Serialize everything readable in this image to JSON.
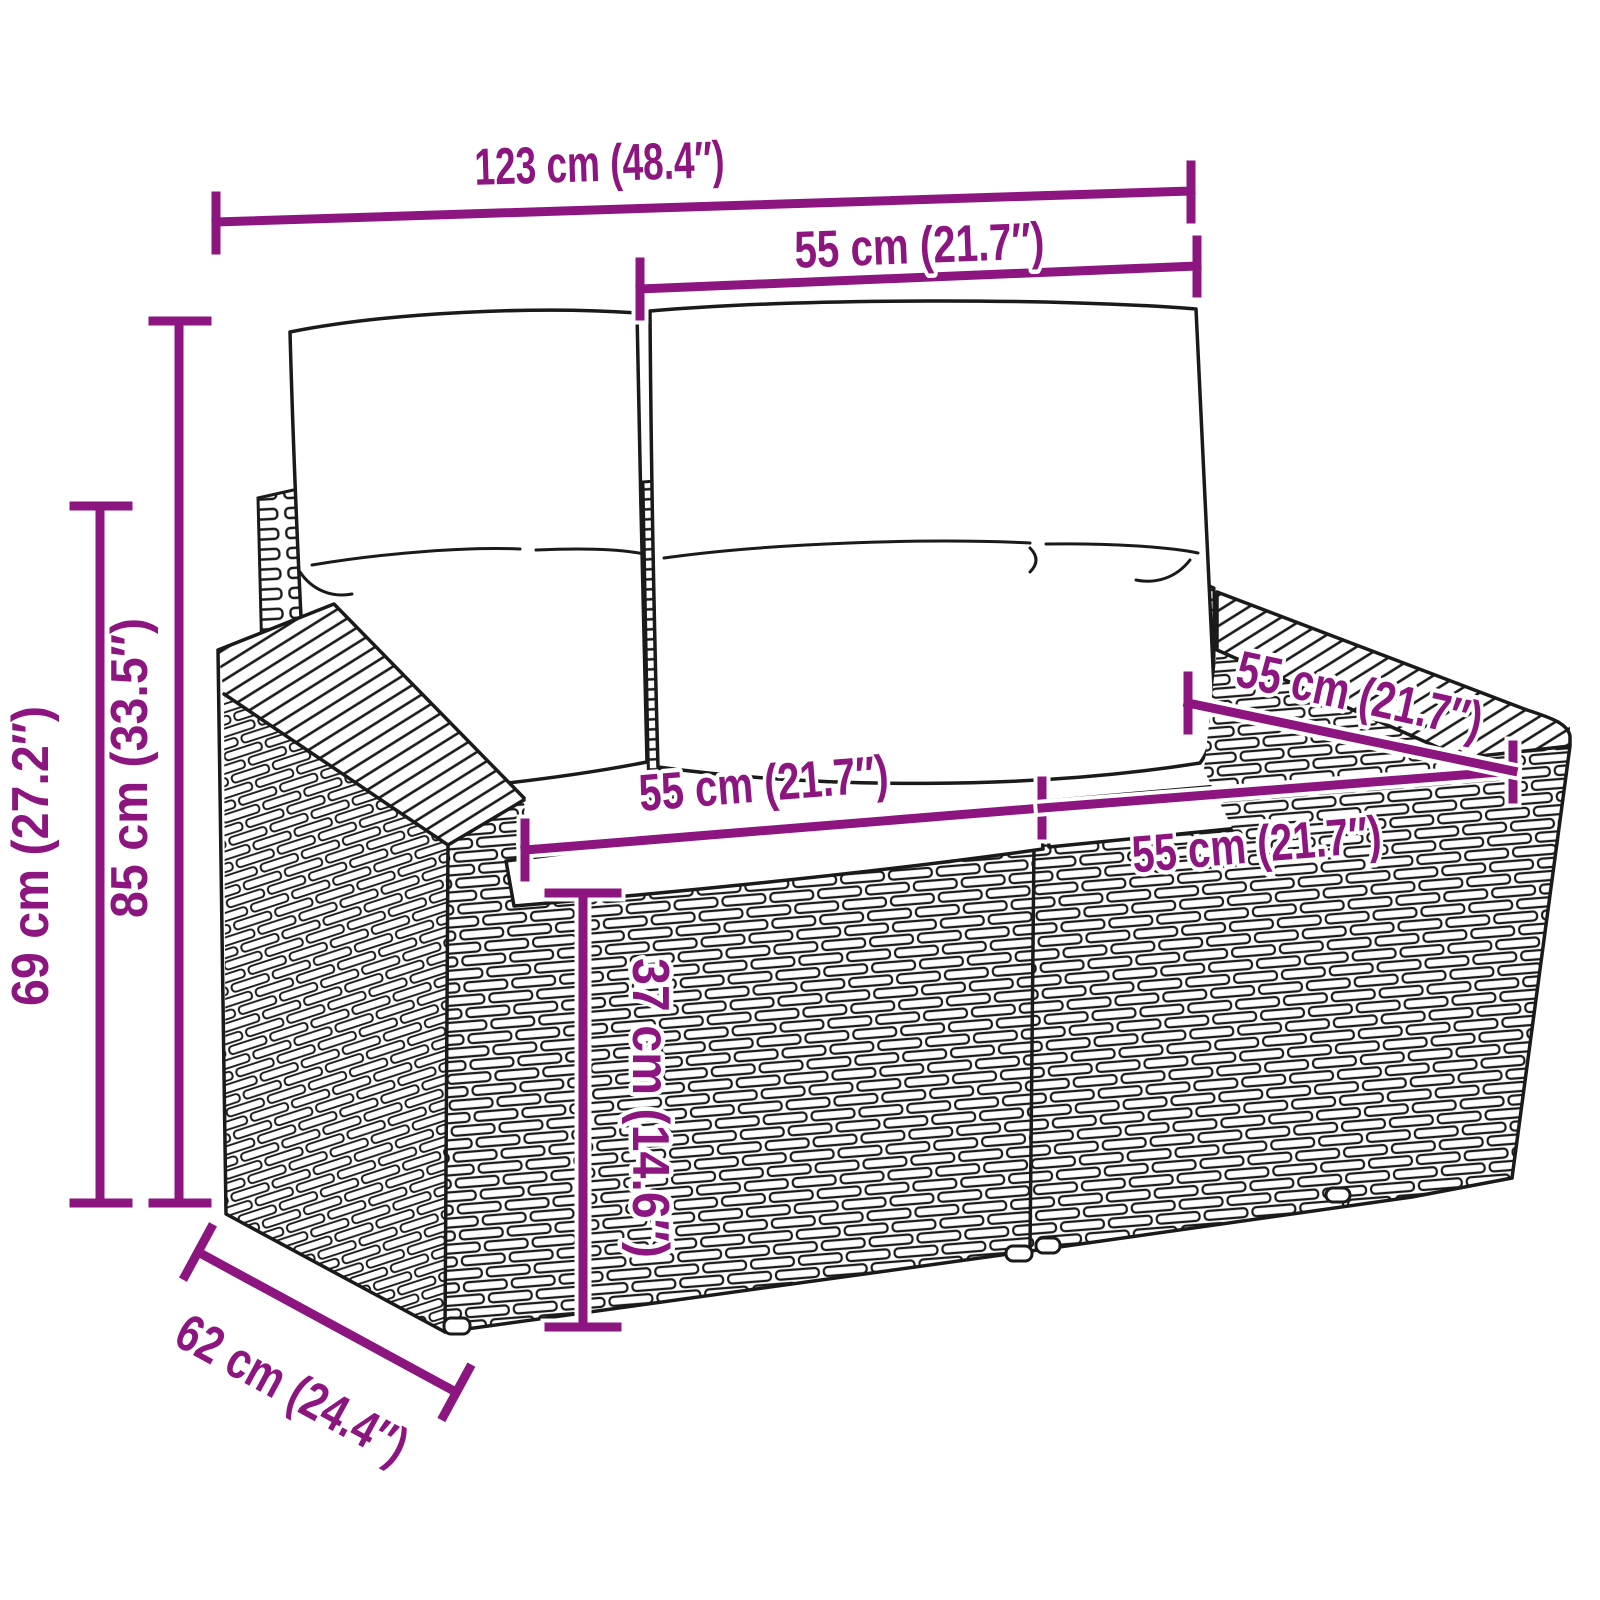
{
  "diagram": {
    "title": "garden-sofa-dimension-diagram",
    "dimensions": {
      "overall_width": "123 cm (48.4″)",
      "backrest_section_width": "55 cm (21.7″)",
      "total_height": "85 cm (33.5″)",
      "armrest_height": "69 cm (27.2″)",
      "left_seat_width": "55 cm (21.7″)",
      "right_seat_width": "55 cm (21.7″)",
      "seat_depth": "55 cm (21.7″)",
      "base_height": "37 cm (14.6″)",
      "overall_depth": "62 cm (24.4″)"
    },
    "colors": {
      "dimension": "#8D1580",
      "line_art": "#1A1A1A",
      "background": "#FFFFFF"
    }
  }
}
